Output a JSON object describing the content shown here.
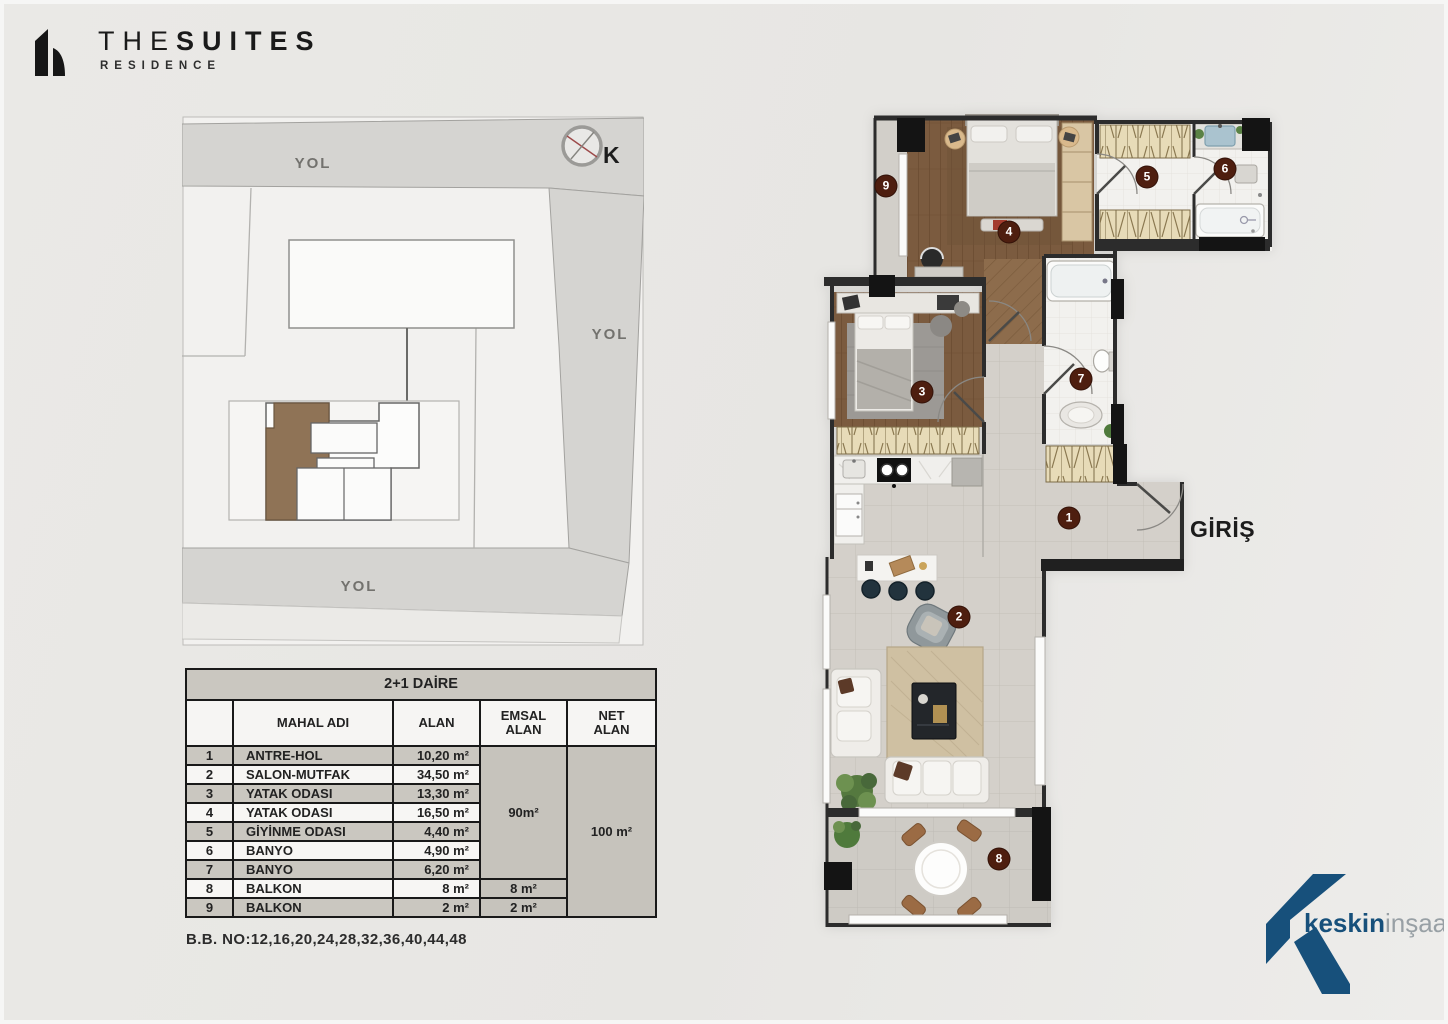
{
  "brand": {
    "title_light": "THE",
    "title_bold": "SUITES",
    "subtitle": "RESIDENCE"
  },
  "site_plan": {
    "road_label_top": "YOL",
    "road_label_right": "YOL",
    "road_label_bottom": "YOL",
    "compass_label": "K"
  },
  "unit_table": {
    "title": "2+1 DAİRE",
    "col_no": "",
    "col_name": "MAHAL ADI",
    "col_area": "ALAN",
    "col_emsal_1": "EMSAL",
    "col_emsal_2": "ALAN",
    "col_net_1": "NET",
    "col_net_2": "ALAN",
    "rows": [
      {
        "no": "1",
        "name": "ANTRE-HOL",
        "area": "10,20 m²"
      },
      {
        "no": "2",
        "name": "SALON-MUTFAK",
        "area": "34,50 m²"
      },
      {
        "no": "3",
        "name": "YATAK ODASI",
        "area": "13,30 m²"
      },
      {
        "no": "4",
        "name": "YATAK ODASI",
        "area": "16,50 m²"
      },
      {
        "no": "5",
        "name": "GİYİNME ODASI",
        "area": "4,40 m²"
      },
      {
        "no": "6",
        "name": "BANYO",
        "area": "4,90 m²"
      },
      {
        "no": "7",
        "name": "BANYO",
        "area": "6,20 m²"
      },
      {
        "no": "8",
        "name": "BALKON",
        "area": "8 m²",
        "emsal": "8 m²"
      },
      {
        "no": "9",
        "name": "BALKON",
        "area": "2 m²",
        "emsal": "2 m²"
      }
    ],
    "emsal_total": "90m²",
    "net_total": "100 m²"
  },
  "note": "B.B. NO:12,16,20,24,28,32,36,40,44,48",
  "floor_plan": {
    "entrance_label": "GİRİŞ",
    "rooms": [
      {
        "no": "1",
        "x": 250,
        "y": 409
      },
      {
        "no": "2",
        "x": 140,
        "y": 508
      },
      {
        "no": "3",
        "x": 103,
        "y": 283
      },
      {
        "no": "4",
        "x": 190,
        "y": 123
      },
      {
        "no": "5",
        "x": 328,
        "y": 68
      },
      {
        "no": "6",
        "x": 406,
        "y": 60
      },
      {
        "no": "7",
        "x": 262,
        "y": 270
      },
      {
        "no": "8",
        "x": 180,
        "y": 750
      },
      {
        "no": "9",
        "x": 67,
        "y": 77
      }
    ]
  },
  "footer_logo": {
    "bold": "keskin",
    "light": "inşaat"
  },
  "colors": {
    "marker": "#4e1e0f",
    "keskin_blue": "#17507b",
    "highlight_unit": "#8f7356",
    "road": "#d5d4d1",
    "wall": "#2c2c2c",
    "wood": "#7b5b3f",
    "tile": "#d4d0ca"
  }
}
